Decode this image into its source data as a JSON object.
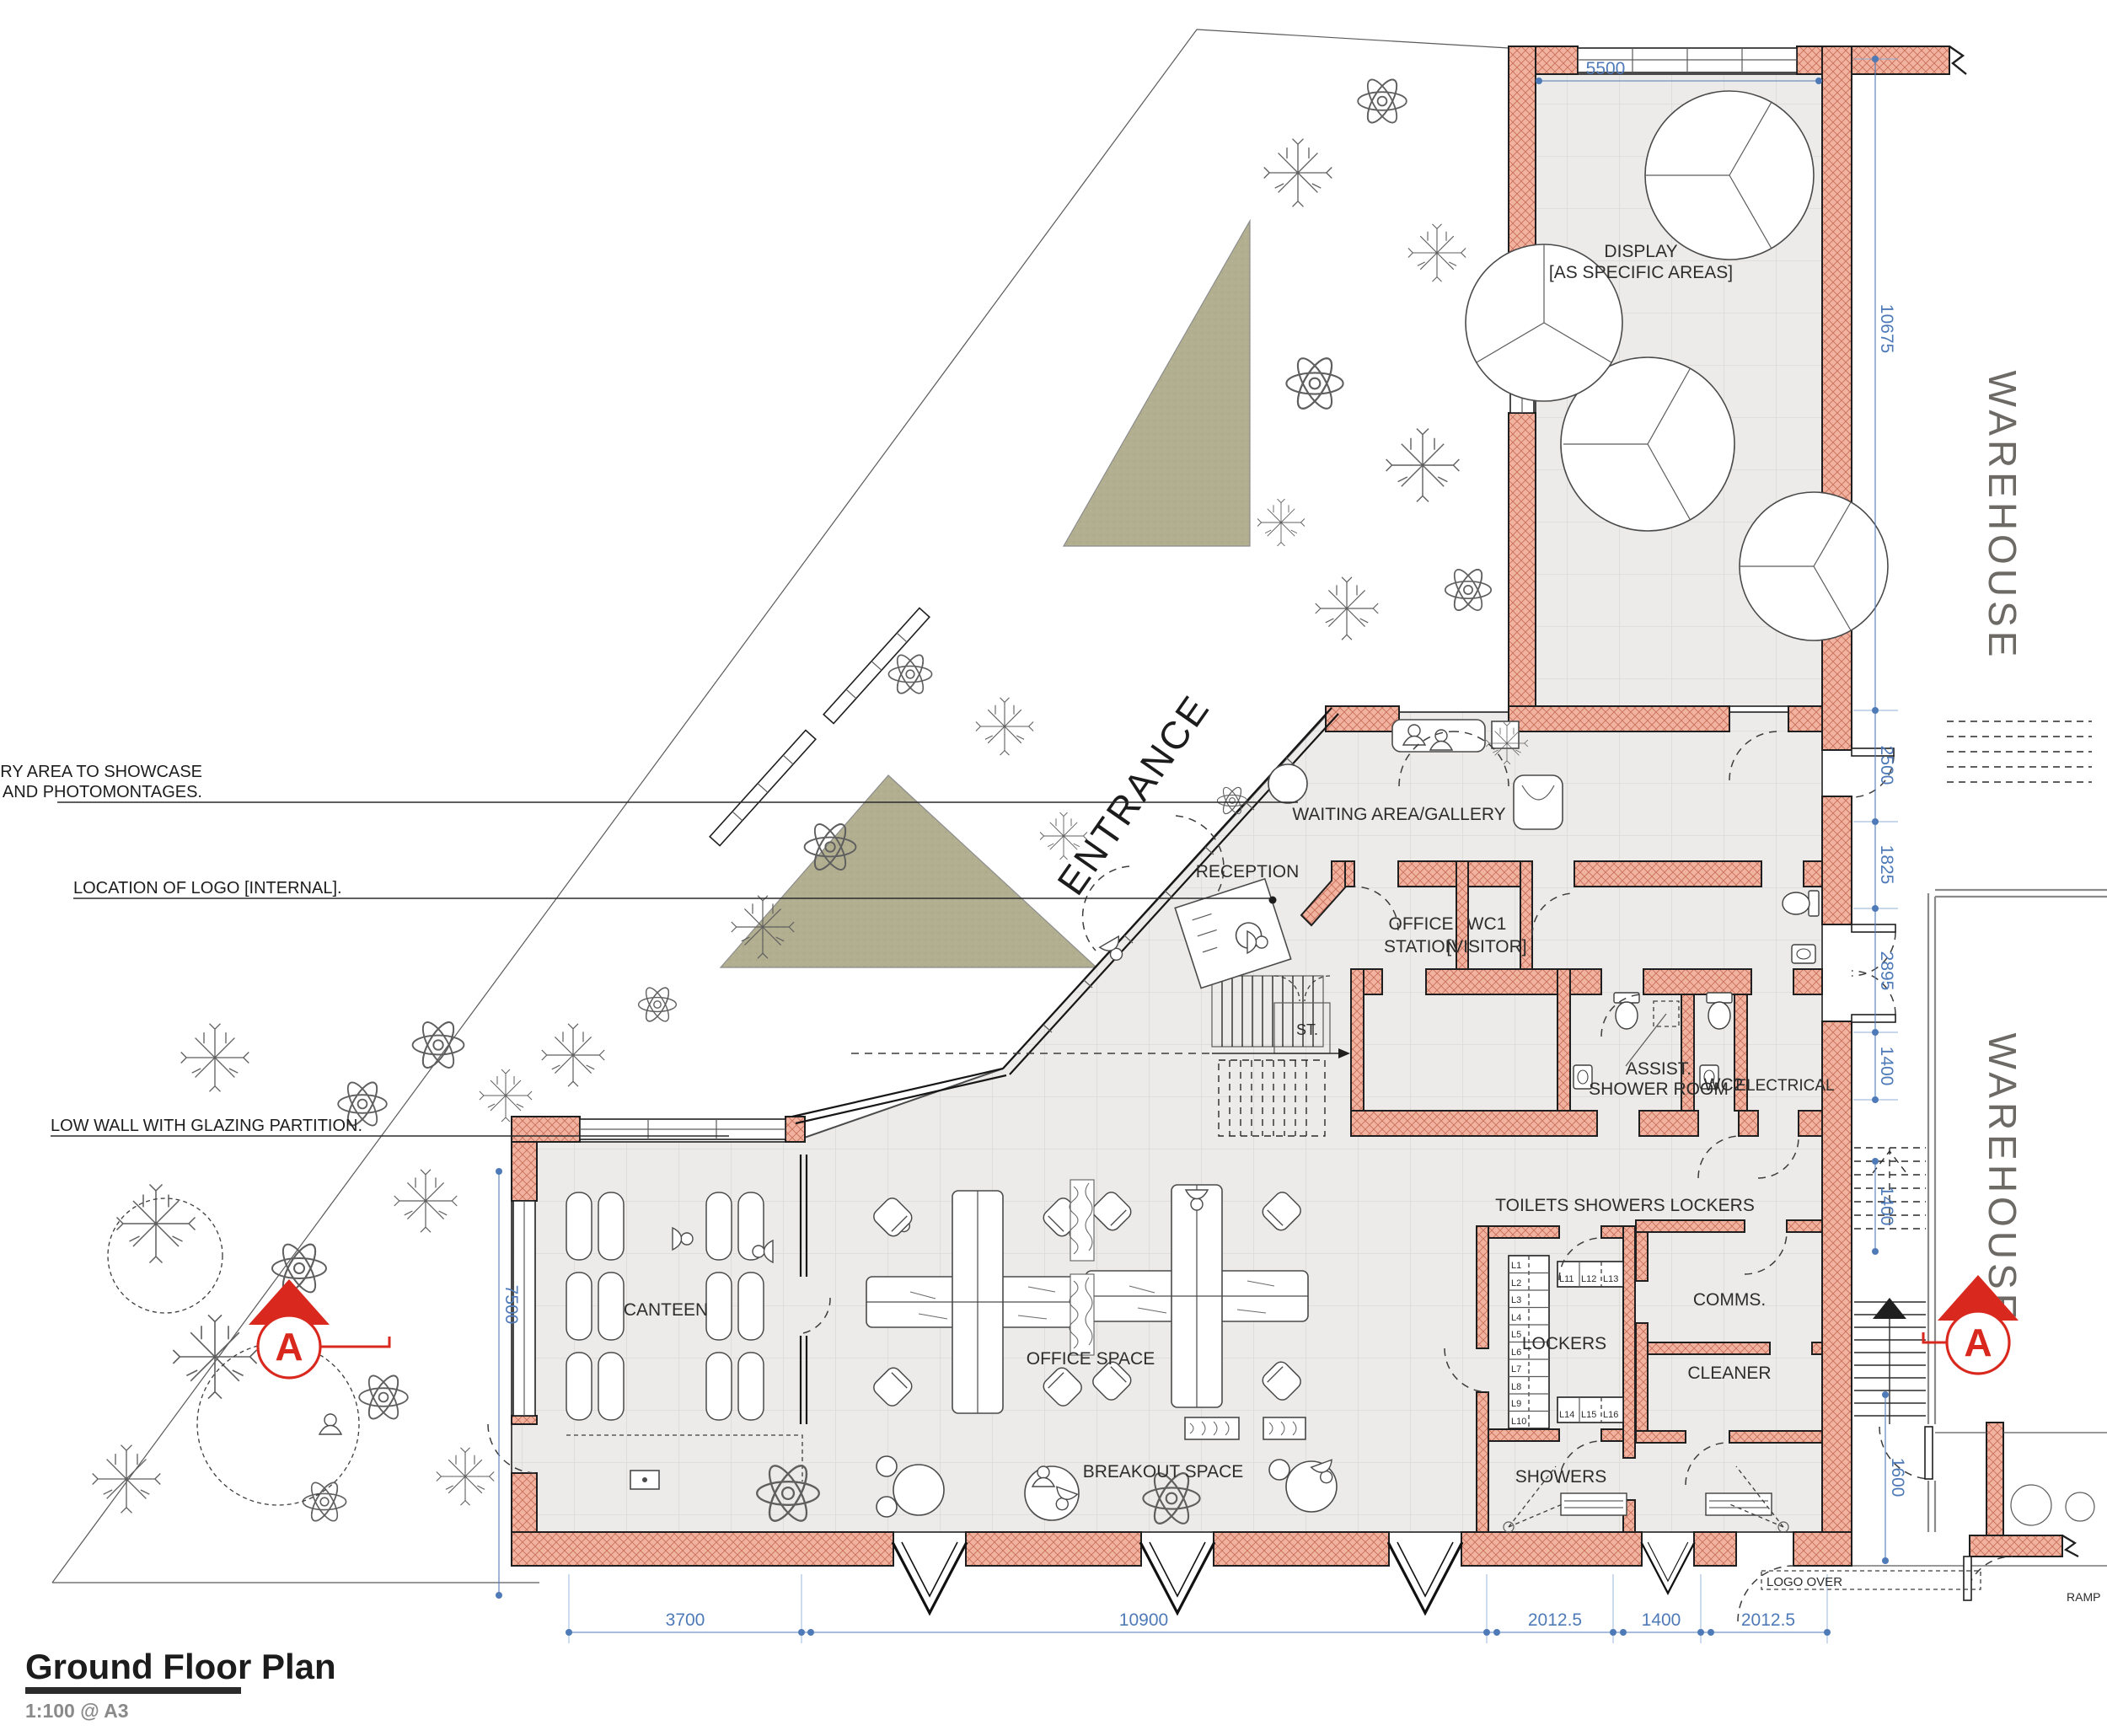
{
  "title": {
    "heading": "Ground Floor Plan",
    "scale_note": "1:100 @ A3"
  },
  "annotations": {
    "gallery_line1": "GALLERY AREA TO SHOWCASE",
    "gallery_line2": "PRODUCTS AND PHOTOMONTAGES.",
    "logo": "LOCATION OF LOGO [INTERNAL].",
    "low_wall": "LOW WALL WITH GLAZING PARTITION."
  },
  "labels": {
    "display_line1": "DISPLAY",
    "display_line2": "[AS SPECIFIC AREAS]",
    "waiting": "WAITING AREA/GALLERY",
    "reception": "RECEPTION",
    "office_station_line1": "OFFICE",
    "office_station_line2": "STATION",
    "wc1_line1": "WC1",
    "wc1_line2": "[VISITOR]",
    "st": "ST.",
    "assist_line1": "ASSIST.",
    "assist_line2": "SHOWER ROOM",
    "wc2": "WC2",
    "electrical": "ELECTRICAL",
    "toilets": "TOILETS SHOWERS LOCKERS",
    "lockers": "LOCKERS",
    "showers": "SHOWERS",
    "comms": "COMMS.",
    "cleaner": "CLEANER",
    "canteen": "CANTEEN",
    "office_space": "OFFICE SPACE",
    "breakout": "BREAKOUT SPACE",
    "entrance": "ENTRANCE",
    "warehouse_upper": "WAREHOUSE",
    "warehouse_lower": "WAREHOUSE",
    "ramp": "RAMP",
    "logo_over": "LOGO OVER"
  },
  "dimensions": {
    "display_width": "5500",
    "right_total": "10675",
    "r1": "2500",
    "r2": "1825",
    "r3": "2895",
    "r4": "1400",
    "stair": "1400",
    "r5": "1600",
    "canteen_glazing": "7500",
    "bottom": [
      "3700",
      "10900",
      "2012.5",
      "1400",
      "2012.5"
    ]
  },
  "lockers": {
    "column": [
      "L1",
      "L2",
      "L3",
      "L4",
      "L5",
      "L6",
      "L7",
      "L8",
      "L9",
      "L10"
    ],
    "row_top": [
      "L11",
      "L12",
      "L13"
    ],
    "row_bottom": [
      "L14",
      "L15",
      "L16"
    ]
  },
  "section_marker": {
    "label": "A"
  },
  "colors": {
    "wall": "#f1b29f",
    "wall_hatch": "#c9705a",
    "floor": "#ecebe9",
    "garden": "#b2af90",
    "dimension": "#4f7ab8",
    "marker": "#d9281e",
    "text": "#2e2e2e",
    "muted": "#6d6a66"
  }
}
